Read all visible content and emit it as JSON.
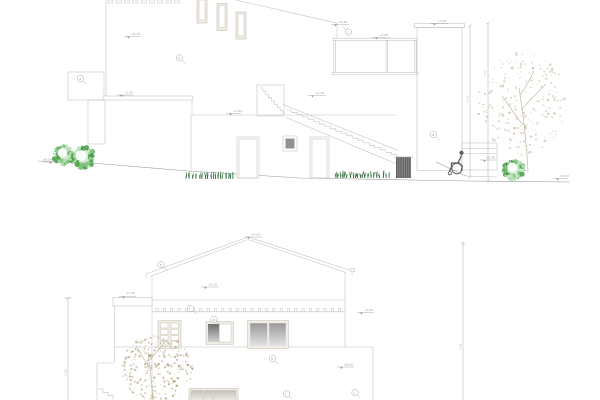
{
  "colors": {
    "background": "#ffffff",
    "line": "#bfbfbf",
    "line_dark": "#9a9a9a",
    "frame": "#c9c2b2",
    "frame_fill": "#efede6",
    "glazing_dark": "#6f6f6f",
    "glazing_light": "#d2d2d2",
    "window_gray": "#919191",
    "hatch": "#5a5a5a",
    "figure": "#5a5a5a",
    "grass": "#2f6e3a",
    "marker": "#9a9a9a",
    "dim": "#a8a8a8",
    "trunk": "#c9c0a8",
    "bush": [
      "#48a048",
      "#7cc47c",
      "#b8e0b8",
      "#ffffff"
    ],
    "bush_dot": "#2f7a2f",
    "tree_top": [
      "#d9d2c2",
      "#cdc5ae"
    ],
    "tree_bottom": [
      "#c6bc9c",
      "#b5ab88"
    ]
  },
  "upper_elevation": {
    "name": "side elevation with external stair and ramp",
    "levels": {
      "wall_mid": "+4.15",
      "slab": "+1.35",
      "ground_left": "±0.00",
      "lower_wall": "+1.50",
      "stair": "+4.15",
      "terrace": "+5.90",
      "rail": "+5.05",
      "tower": "+7.55",
      "ramp": "+0.45",
      "ground_right": "±0.00"
    },
    "keynotes": {
      "k1": "a",
      "k2": "b",
      "k3": "c",
      "k4": "d"
    },
    "dimensions": {
      "inner": "7.10",
      "outer": "7.55"
    }
  },
  "lower_elevation": {
    "name": "garden elevation with pitched roof",
    "levels": {
      "ridge": "+7.45",
      "eaves": "+5.10",
      "parapet": "+3.30",
      "floor": "+3.05",
      "ground": "±0.00"
    },
    "keynotes": {
      "r1": "e",
      "r2": "f",
      "r3": "g",
      "r4": "h",
      "r5": "i",
      "r6": "j"
    },
    "dimensions": {
      "left": "3.30",
      "right": "7.45"
    }
  }
}
